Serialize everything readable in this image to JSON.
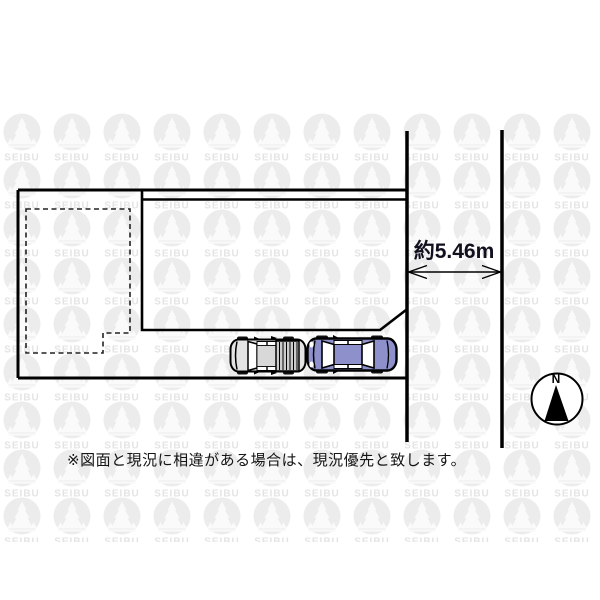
{
  "watermark": {
    "text": "SEIBU",
    "circle_color": "#ececec",
    "icon_color": "#fafafa",
    "text_color": "#e4e4e4"
  },
  "road": {
    "dimension_label": "約5.46m",
    "dimension_value_m": 5.46
  },
  "compass": {
    "label": "N"
  },
  "footer": {
    "note": "※図面と現況に相違がある場合は、現況優先と致します。"
  },
  "colors": {
    "line": "#000000",
    "car_blue_body": "#8d90cb",
    "car_gray_body": "#e4e4e4",
    "car_gray_hatch": "#cccccc",
    "window_white": "#ffffff"
  }
}
